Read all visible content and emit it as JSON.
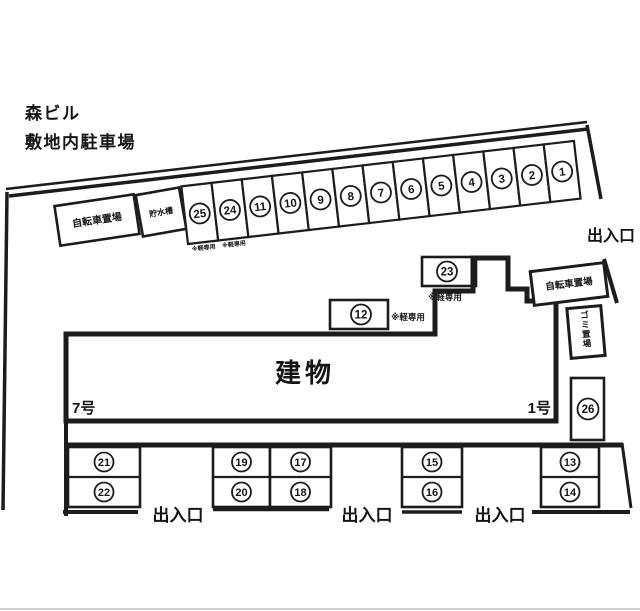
{
  "title": {
    "building_name": "森ビル",
    "subtitle": "敷地内駐車場"
  },
  "labels": {
    "building": "建物",
    "unit_left": "7号",
    "unit_right": "1号",
    "bicycle_parking_top": "自転車置場",
    "bicycle_parking_right": "自転車置場",
    "water_tank": "貯水槽",
    "garbage_area": "ゴミ置場",
    "kei_only_note": "※軽専用"
  },
  "entrances": {
    "top_right": "出入口",
    "bottom_left": "出入口",
    "bottom_center": "出入口",
    "bottom_right": "出入口"
  },
  "parking": {
    "diagonal_row_spaces": [
      "25",
      "24",
      "11",
      "10",
      "9",
      "8",
      "7",
      "6",
      "5",
      "4",
      "3",
      "2",
      "1"
    ],
    "diagonal_row_kei_only": [
      "25",
      "24"
    ],
    "space_23": "23",
    "space_12": "12",
    "space_26": "26",
    "bottom_row_pairs": [
      [
        "21",
        "22"
      ],
      [
        "19",
        "20"
      ],
      [
        "17",
        "18"
      ],
      [
        "15",
        "16"
      ],
      [
        "13",
        "14"
      ]
    ]
  },
  "colors": {
    "line": "#1c1c1c",
    "background": "#ffffff",
    "scan_edge": "#c0c0c0"
  }
}
